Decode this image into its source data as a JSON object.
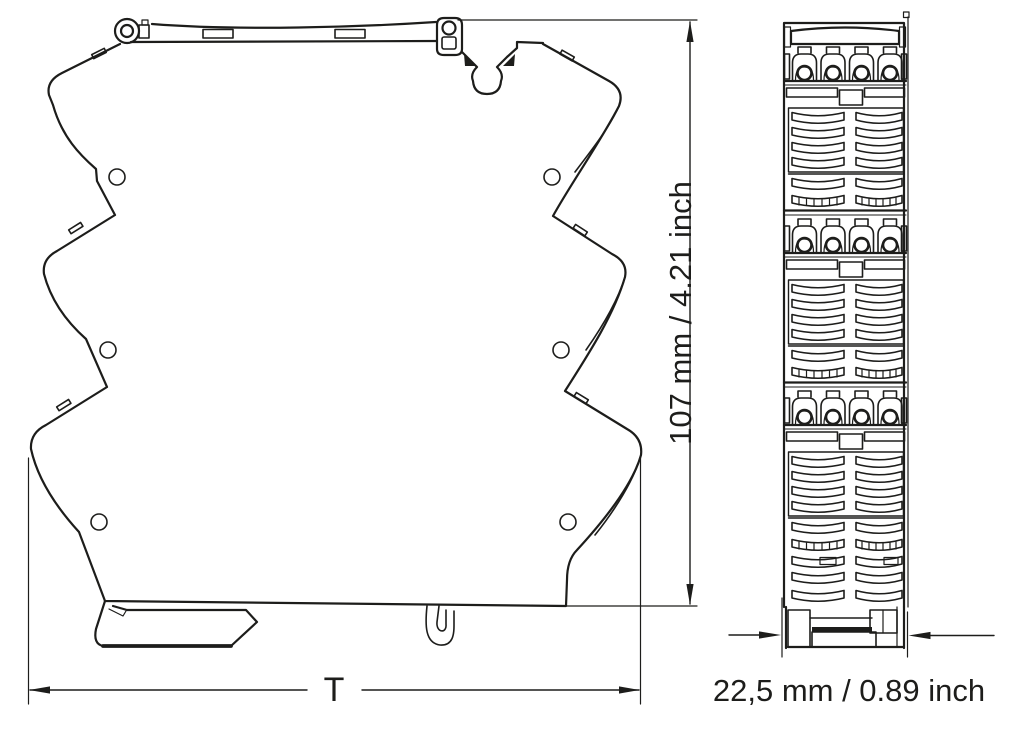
{
  "colors": {
    "line": "#1d1d1b",
    "background": "#ffffff"
  },
  "dimensions": {
    "height": {
      "label": "107 mm / 4.21 inch"
    },
    "total_width": {
      "label": "T"
    },
    "module_width": {
      "label": "22,5 mm / 0.89 inch"
    }
  }
}
